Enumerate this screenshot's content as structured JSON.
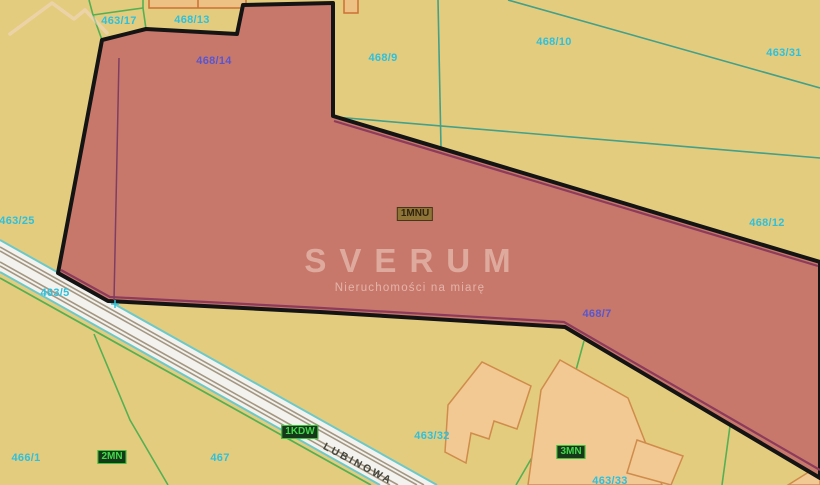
{
  "map": {
    "watermark": {
      "title": "SVERUM",
      "subtitle": "Nieruchomości na miarę"
    },
    "street": {
      "name": "LUBINOWA"
    },
    "parcel_labels": [
      {
        "id": "463/17",
        "x": 119,
        "y": 21,
        "color": "cyan"
      },
      {
        "id": "468/13",
        "x": 192,
        "y": 20,
        "color": "cyan"
      },
      {
        "id": "468/14",
        "x": 214,
        "y": 61,
        "color": "blue"
      },
      {
        "id": "468/9",
        "x": 383,
        "y": 58,
        "color": "cyan"
      },
      {
        "id": "468/10",
        "x": 554,
        "y": 42,
        "color": "cyan"
      },
      {
        "id": "463/31",
        "x": 784,
        "y": 53,
        "color": "cyan"
      },
      {
        "id": "463/25",
        "x": 17,
        "y": 221,
        "color": "cyan"
      },
      {
        "id": "463/5",
        "x": 55,
        "y": 293,
        "color": "cyan"
      },
      {
        "id": "468/12",
        "x": 767,
        "y": 223,
        "color": "cyan"
      },
      {
        "id": "468/7",
        "x": 597,
        "y": 314,
        "color": "blue"
      },
      {
        "id": "466/1",
        "x": 26,
        "y": 458,
        "color": "cyan"
      },
      {
        "id": "467",
        "x": 220,
        "y": 458,
        "color": "cyan"
      },
      {
        "id": "463/32",
        "x": 432,
        "y": 436,
        "color": "cyan"
      },
      {
        "id": "463/33",
        "x": 610,
        "y": 481,
        "color": "cyan"
      }
    ],
    "zone_labels": [
      {
        "id": "1MNU",
        "x": 415,
        "y": 214,
        "style": "olive"
      },
      {
        "id": "2MN",
        "x": 112,
        "y": 457,
        "style": "green"
      },
      {
        "id": "1KDW",
        "x": 300,
        "y": 432,
        "style": "green"
      },
      {
        "id": "3MN",
        "x": 571,
        "y": 452,
        "style": "green"
      }
    ],
    "colors": {
      "background": "#e4cc7e",
      "highlight_parcel": "#c8786b",
      "highlight_border": "#141414",
      "zone_maroon_line": "#8c3b5a",
      "parcel_line_teal": "#43a089",
      "parcel_line_green": "#55b054",
      "road_fill": "#f3f2ee",
      "road_edge_cyan": "#6cc9c9",
      "road_lane": "#a39782",
      "building_fill": "#f2c893",
      "building_border": "#cf8c4b",
      "label_cyan": "#2ec0dc",
      "label_blue": "#5856ce",
      "zone_badge_green": "#42d84a",
      "watermark": "#f4d8ce"
    }
  }
}
